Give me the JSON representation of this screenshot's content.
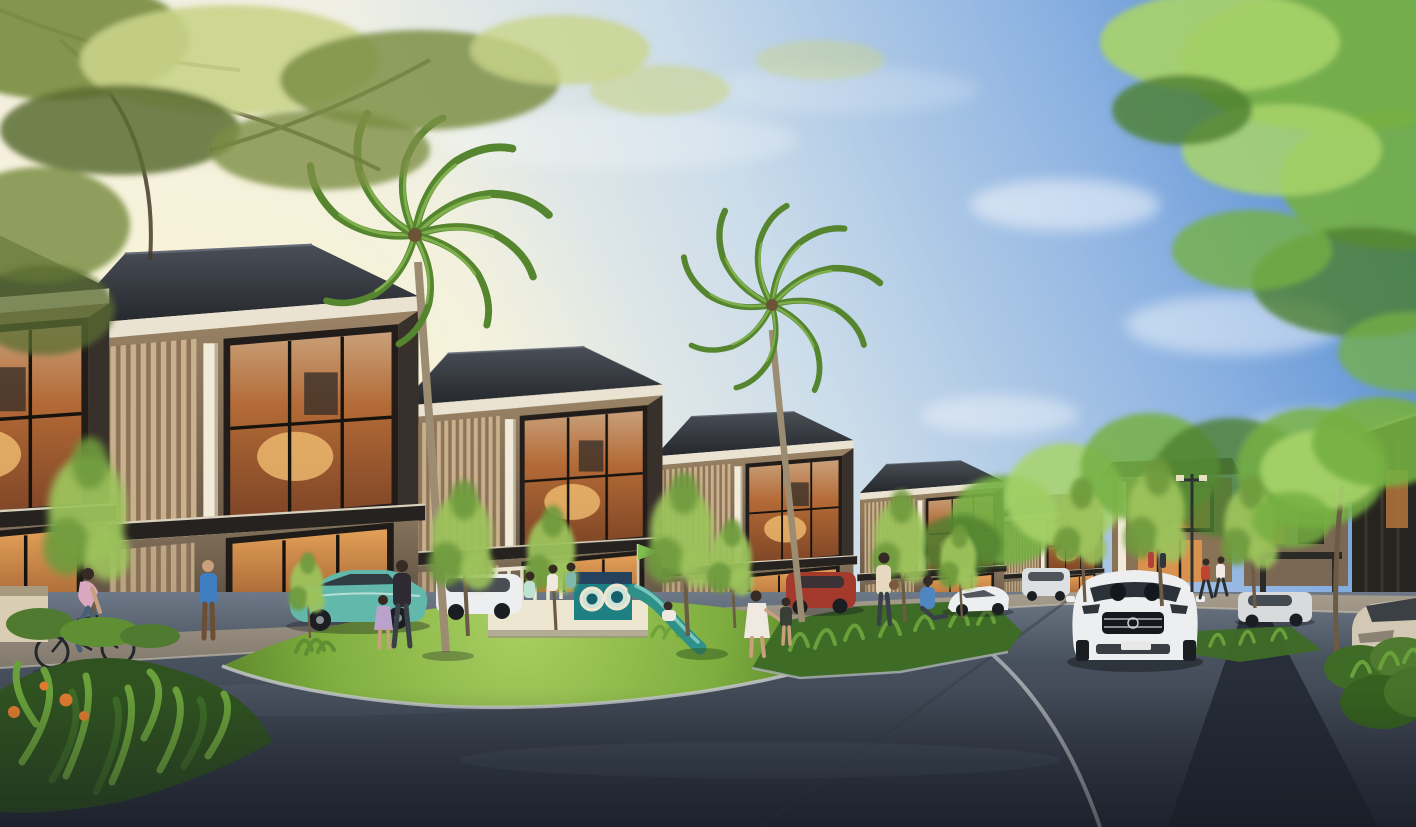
{
  "scene": {
    "type": "architectural-rendering",
    "description": "Golden-hour rendering of a modern tropical townhouse cluster: a receding row of two-storey dark-roofed homes with warm lit glass facades and timber slat screens, a curved asphalt street around a grass island with a teal children's playground and slide, two tall palms, ornamental young trees, parked and moving cars, cyclists and pedestrians, lush shrubs in the foreground corners under a sky that shifts from warm cream light on the left to clear blue on the right.",
    "time_of_day": "late afternoon golden hour",
    "setting": "residential estate street corner"
  },
  "palette": {
    "sky_blue_deep": "#4a84ce",
    "sky_blue": "#8fb4e2",
    "sky_pale": "#cbdcea",
    "sky_warm": "#f8f1dc",
    "sun_glow": "#fcf5cf",
    "cloud_white": "#ffffff",
    "foliage_olive": "#7d8f45",
    "foliage_olive_light": "#c9d489",
    "foliage_olive_dark": "#5a6c33",
    "foliage_green": "#76b043",
    "foliage_green_light": "#a8d36a",
    "foliage_green_dark": "#4e8030",
    "tree_young": "#9cc25c",
    "tree_young_dark": "#6e9a3c",
    "palm_green": "#55862f",
    "palm_green_light": "#7faf4c",
    "palm_trunk": "#9c8c72",
    "roof_dark": "#2e3238",
    "roof_ridge": "#646b74",
    "fascia_cream": "#ebe3d1",
    "wall_wood": "#8f7a5e",
    "wall_wood_dark": "#5e4f41",
    "slat_light": "#c8b18c",
    "slat_dark": "#8e7358",
    "column_white": "#f2ebd9",
    "glass_warm": "#d9924e",
    "glass_warm_deep": "#8a4e2c",
    "lamp_glow": "#f6c476",
    "canopy_dark": "#26221f",
    "road_light": "#6e7987",
    "road_mid": "#49525f",
    "road_dark": "#272d38",
    "paver_dark": "#20262f",
    "walkway": "#a29a8c",
    "curb": "#c3c6c9",
    "grass_light": "#a9cf62",
    "grass": "#7fae3f",
    "grass_dark": "#567f28",
    "shrub": "#3e6b26",
    "shrub_light": "#69a03a",
    "flower_orange": "#e07a2e",
    "play_teal": "#1f8083",
    "play_teal_dark": "#14606b",
    "play_navy": "#24415e",
    "play_cream": "#ede7d2",
    "car_white": "#edeef0",
    "car_teal": "#63b8ac",
    "car_red": "#a33a2b",
    "car_champagne": "#d3c8b4",
    "car_silver": "#d8dadc",
    "car_glass": "#2a3138",
    "tire_dark": "#1a1d22",
    "skin": "#c99f7e",
    "hair_dark": "#362b24",
    "shirt_blue": "#3f7ec0",
    "shirt_pink": "#d9a8c0",
    "jeans": "#4a5e78",
    "dress_white": "#efe9e2",
    "dress_lilac": "#b9a3cc",
    "shirt_mint": "#bfe3d2",
    "shirt_red": "#c04434",
    "shirt_cream": "#e6d9bf"
  },
  "objects": {
    "townhouse_units_visible": 6,
    "distant_houses": [
      "center-lane-house",
      "pergola-gate",
      "right-dark-house"
    ],
    "palms": 2,
    "young_street_trees": 12,
    "playground": {
      "parts": [
        "white-railing-deck",
        "navy-crest-panel",
        "teal-porthole-panel",
        "two-porthole-windows",
        "teal-slide",
        "flag-pole"
      ],
      "color_theme": "teal-navy-cream"
    },
    "cars": [
      {
        "label": "white-sedan-driving",
        "view": "front",
        "position": "center-right road"
      },
      {
        "label": "teal-parked-sedan",
        "view": "side",
        "position": "left walkway"
      },
      {
        "label": "white-estate-parked",
        "view": "side",
        "position": "behind teal sedan"
      },
      {
        "label": "red-parked-car",
        "view": "side",
        "position": "center walkway"
      },
      {
        "label": "white-coupe-parked",
        "view": "three-quarter",
        "position": "right of island"
      },
      {
        "label": "grey-minivan-distant",
        "view": "rear",
        "position": "near vanishing point"
      },
      {
        "label": "silver-sedan-distant",
        "view": "three-quarter",
        "position": "right lane"
      },
      {
        "label": "champagne-sedan-parked",
        "view": "front-quarter",
        "position": "right edge"
      }
    ],
    "people": [
      "cyclist-left",
      "man-blue-shirt",
      "woman-with-child",
      "three-kids-on-playdeck",
      "child-on-slide",
      "girl-white-dress",
      "child-dark-shirt",
      "woman-cream-top",
      "seated-person-blue",
      "two-joggers-distant",
      "couple-at-distant-house"
    ],
    "vegetation": [
      "olive-tree-canopy-top-left",
      "green-tree-canopy-top-right",
      "flowering-shrubs-bottom-left",
      "hedge-bottom-right",
      "grass-island",
      "planting-bed-corner"
    ]
  }
}
